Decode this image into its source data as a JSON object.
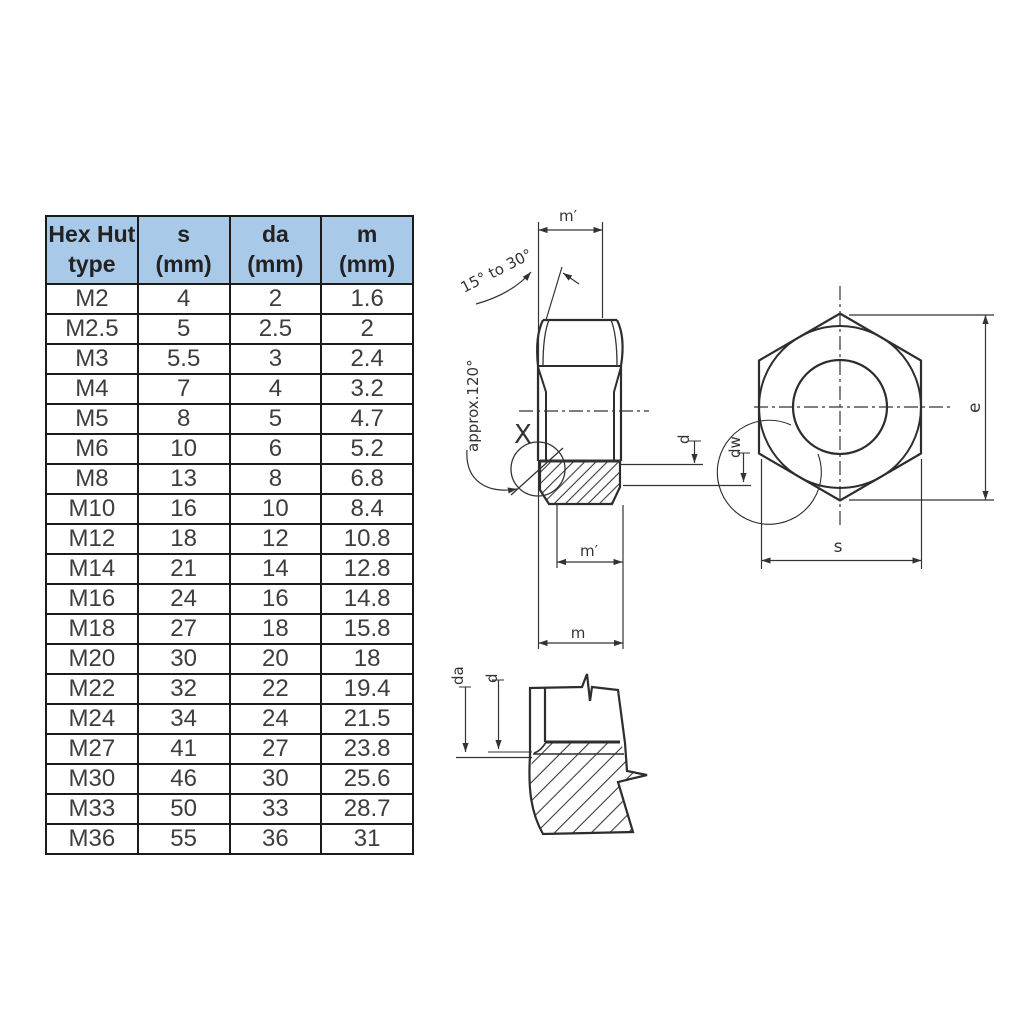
{
  "table": {
    "headers": [
      {
        "line1": "Hex Hut",
        "line2": "type"
      },
      {
        "line1": "s",
        "line2": "(mm)"
      },
      {
        "line1": "da",
        "line2": "(mm)"
      },
      {
        "line1": "m",
        "line2": "(mm)"
      }
    ],
    "rows": [
      [
        "M2",
        "4",
        "2",
        "1.6"
      ],
      [
        "M2.5",
        "5",
        "2.5",
        "2"
      ],
      [
        "M3",
        "5.5",
        "3",
        "2.4"
      ],
      [
        "M4",
        "7",
        "4",
        "3.2"
      ],
      [
        "M5",
        "8",
        "5",
        "4.7"
      ],
      [
        "M6",
        "10",
        "6",
        "5.2"
      ],
      [
        "M8",
        "13",
        "8",
        "6.8"
      ],
      [
        "M10",
        "16",
        "10",
        "8.4"
      ],
      [
        "M12",
        "18",
        "12",
        "10.8"
      ],
      [
        "M14",
        "21",
        "14",
        "12.8"
      ],
      [
        "M16",
        "24",
        "16",
        "14.8"
      ],
      [
        "M18",
        "27",
        "18",
        "15.8"
      ],
      [
        "M20",
        "30",
        "20",
        "18"
      ],
      [
        "M22",
        "32",
        "22",
        "19.4"
      ],
      [
        "M24",
        "34",
        "24",
        "21.5"
      ],
      [
        "M27",
        "41",
        "27",
        "23.8"
      ],
      [
        "M30",
        "46",
        "30",
        "25.6"
      ],
      [
        "M33",
        "50",
        "33",
        "28.7"
      ],
      [
        "M36",
        "55",
        "36",
        "31"
      ]
    ]
  },
  "diagram": {
    "side": {
      "m_prime_top": "m′",
      "chamfer_angle_note": "15° to 30°",
      "countersink_angle_note": "approx.120°",
      "detail_marker": "X",
      "d_label": "d",
      "dw_label": "dw",
      "m_prime_bottom": "m′",
      "m_label": "m"
    },
    "front": {
      "e_label": "e",
      "s_label": "s"
    },
    "detail": {
      "da_label": "da",
      "d_label": "d"
    }
  },
  "colors": {
    "header_bg": "#a9c9e9",
    "table_border": "#1b1b1b",
    "line": "#2d2d2d",
    "text": "#3d3d3d"
  }
}
